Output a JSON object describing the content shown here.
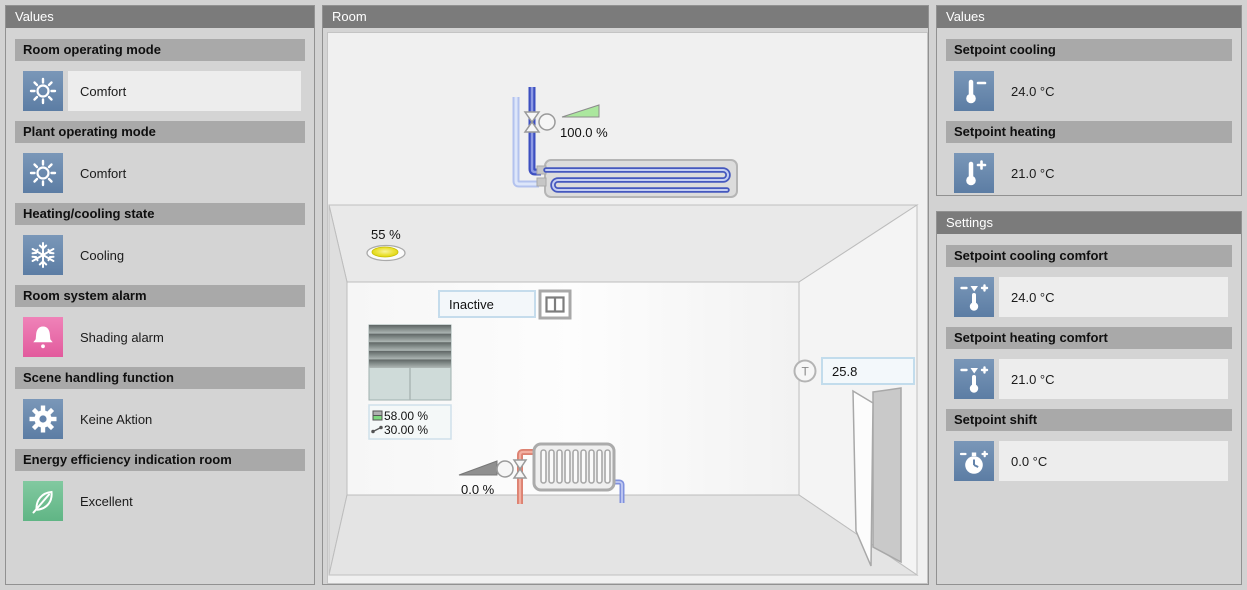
{
  "left_panel": {
    "title": "Values",
    "sections": [
      {
        "label": "Room operating mode",
        "icon": "sun-icon",
        "value": "Comfort"
      },
      {
        "label": "Plant operating mode",
        "icon": "sun-icon",
        "value": "Comfort"
      },
      {
        "label": "Heating/cooling state",
        "icon": "snowflake-icon",
        "value": "Cooling"
      },
      {
        "label": "Room system alarm",
        "icon": "bell-icon",
        "value": "Shading alarm"
      },
      {
        "label": "Scene handling function",
        "icon": "gear-icon",
        "value": "Keine Aktion"
      },
      {
        "label": "Energy efficiency indication room",
        "icon": "leaf-icon",
        "value": "Excellent"
      }
    ]
  },
  "room_panel": {
    "title": "Room",
    "ceiling_cooling_valve": "100.0 %",
    "light_dimmer": "55 %",
    "window_state": "Inactive",
    "blinds_height": "58.00 %",
    "blinds_angle": "30.00 %",
    "radiator_valve": "0.0 %",
    "temperature": "25.8",
    "temperature_sensor_label": "T"
  },
  "right_values_panel": {
    "title": "Values",
    "sections": [
      {
        "label": "Setpoint cooling",
        "icon": "thermometer-minus-icon",
        "value": "24.0 °C"
      },
      {
        "label": "Setpoint heating",
        "icon": "thermometer-plus-icon",
        "value": "21.0 °C"
      }
    ]
  },
  "right_settings_panel": {
    "title": "Settings",
    "sections": [
      {
        "label": "Setpoint cooling comfort",
        "icon": "thermometer-adjust-icon",
        "value": "24.0 °C"
      },
      {
        "label": "Setpoint heating comfort",
        "icon": "thermometer-adjust-icon",
        "value": "21.0 °C"
      },
      {
        "label": "Setpoint shift",
        "icon": "dial-adjust-icon",
        "value": "0.0 °C"
      }
    ]
  },
  "colors": {
    "tile_blue": "#6383ab",
    "alarm_pink": "#e766a7",
    "eco_green": "#6fbe8f",
    "panel_header_gray": "#7b7b7b",
    "section_bar_gray": "#a9a9a9",
    "valve_open_green": "#abe79e",
    "valve_closed_gray": "#8f8f8f",
    "chilled_water_blue": "#3d4fc0",
    "hot_water_red": "#dd8272"
  }
}
